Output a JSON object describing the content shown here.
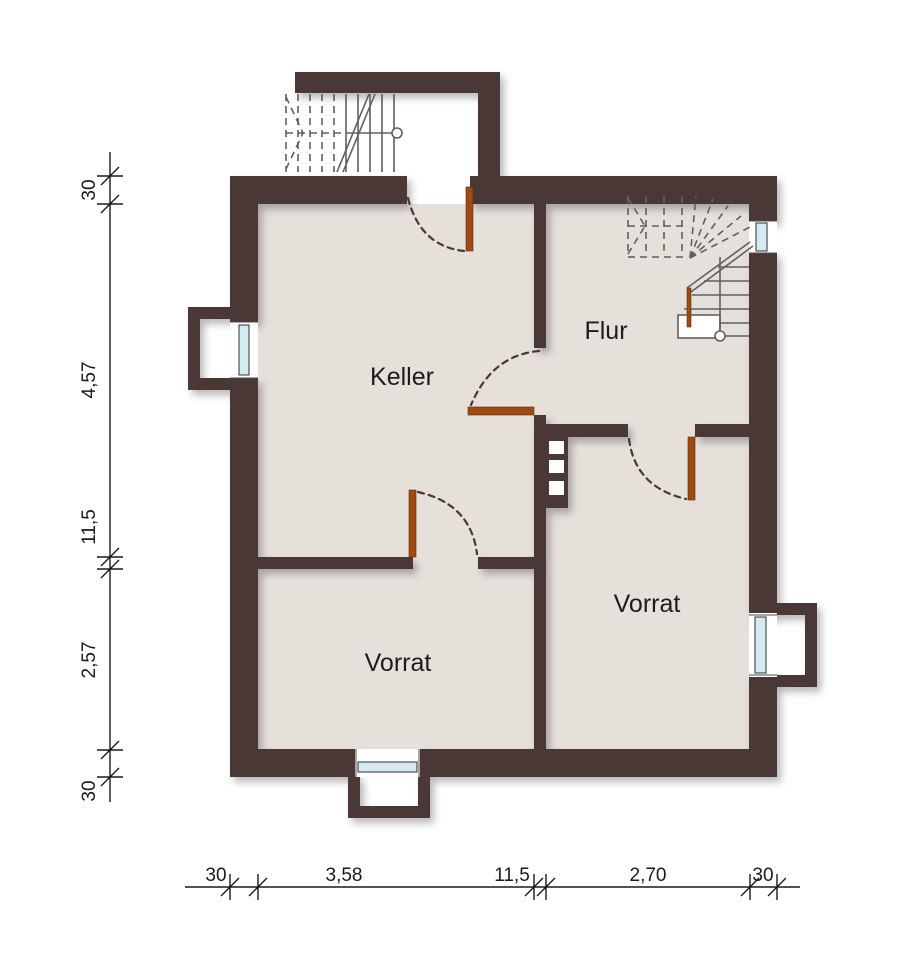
{
  "rooms": {
    "keller": "Keller",
    "flur": "Flur",
    "vorrat_left": "Vorrat",
    "vorrat_right": "Vorrat"
  },
  "dimensions": {
    "left": [
      "30",
      "4,57",
      "11,5",
      "2,57",
      "30"
    ],
    "bottom": [
      "30",
      "3,58",
      "11,5",
      "2,70",
      "30"
    ]
  },
  "colors": {
    "wall": "#483835",
    "floor": "#e6e0db",
    "door": "#9e4a10",
    "glass": "#d6ebf1",
    "stair": "#606060",
    "dim": "#1a1a1a",
    "text": "#1c1c1c"
  }
}
